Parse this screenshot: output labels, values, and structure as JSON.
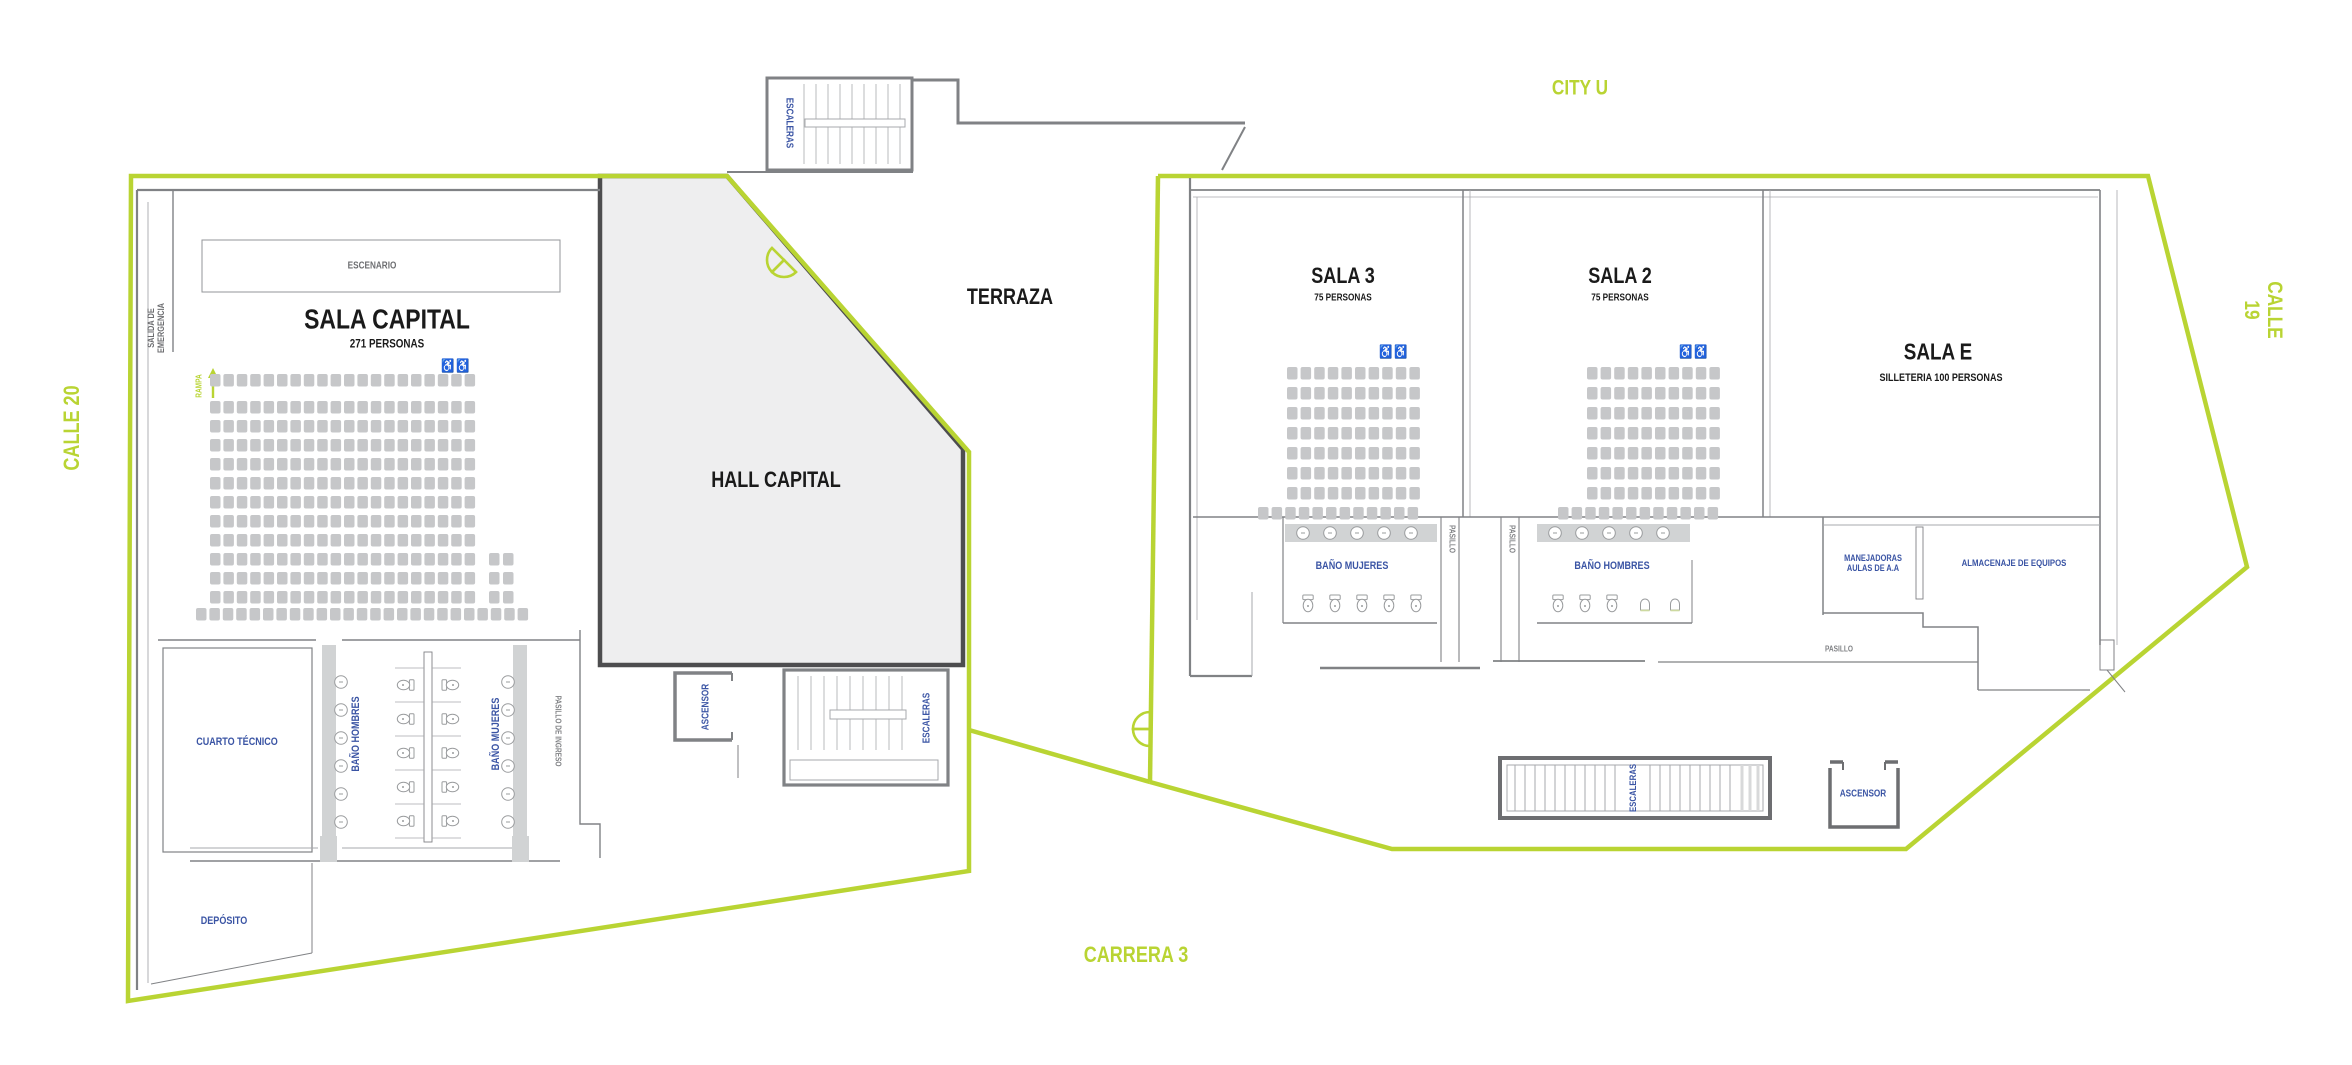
{
  "streets": {
    "left": "CALLE 20",
    "top": "CITY U",
    "right": "CALLE 19",
    "bottom": "CARRERA 3"
  },
  "left_building": {
    "stage": "ESCENARIO",
    "emergency_exit": "SALIDA DE\nEMERGENCIA",
    "ramp": "RAMPA",
    "sala_capital": {
      "title": "SALA CAPITAL",
      "capacity": "271 PERSONAS"
    },
    "hall": "HALL CAPITAL",
    "terrace": "TERRAZA",
    "stairs_top": "ESCALERAS",
    "stairs": "ESCALERAS",
    "elevator": "ASCENSOR",
    "technical_room": "CUARTO TÉCNICO",
    "men_bathroom": "BAÑO HOMBRES",
    "women_bathroom": "BAÑO MUJERES",
    "entry_corridor": "PASILLO DE INGRESO",
    "storage": "DEPÓSITO"
  },
  "right_building": {
    "sala_3": {
      "title": "SALA 3",
      "capacity": "75 PERSONAS"
    },
    "sala_2": {
      "title": "SALA 2",
      "capacity": "75 PERSONAS"
    },
    "sala_e": {
      "title": "SALA E",
      "capacity": "SILLETERIA 100 PERSONAS"
    },
    "women_bathroom": "BAÑO MUJERES",
    "men_bathroom": "BAÑO HOMBRES",
    "corridor_a": "PASILLO",
    "corridor_b": "PASILLO",
    "corridor_c": "PASILLO",
    "ahu_room": "MANEJADORAS\nAULAS DE A.A",
    "equipment_storage": "ALMACENAJE DE EQUIPOS",
    "stairs": "ESCALERAS",
    "elevator": "ASCENSOR"
  },
  "icons": {
    "wheelchair_pair": "♿♿"
  },
  "colors": {
    "accent_green": "#b9d433",
    "label_blue": "#3a54a4",
    "wall_gray": "#808285",
    "wall_light": "#a7a9ac",
    "wall_fill": "#d1d3d4",
    "hall_fill": "#eeeeef",
    "seat_gray": "#c6c7c9"
  },
  "seat_blocks": [
    {
      "name": "sala-capital-front",
      "x": 210,
      "y": 374,
      "rows": 1,
      "cols": 20,
      "pitch_x": 13.4,
      "pitch_y": 19,
      "seat_w": 10.5,
      "seat_h": 12.5
    },
    {
      "name": "sala-capital-main",
      "x": 210,
      "y": 401,
      "rows": 11,
      "cols": 20,
      "pitch_x": 13.4,
      "pitch_y": 19,
      "seat_w": 10.5,
      "seat_h": 12.5
    },
    {
      "name": "sala-capital-side",
      "x": 489,
      "y": 553,
      "rows": 3,
      "cols": 2,
      "pitch_x": 14,
      "pitch_y": 19,
      "seat_w": 10.5,
      "seat_h": 12.5
    },
    {
      "name": "sala-capital-back",
      "x": 196,
      "y": 608,
      "rows": 1,
      "cols": 25,
      "pitch_x": 13.4,
      "pitch_y": 19,
      "seat_w": 10.5,
      "seat_h": 12.5
    },
    {
      "name": "sala3-main",
      "x": 1287,
      "y": 367,
      "rows": 7,
      "cols": 10,
      "pitch_x": 13.6,
      "pitch_y": 20,
      "seat_w": 10.5,
      "seat_h": 12.5
    },
    {
      "name": "sala3-back",
      "x": 1258,
      "y": 507,
      "rows": 1,
      "cols": 12,
      "pitch_x": 13.6,
      "pitch_y": 20,
      "seat_w": 10.5,
      "seat_h": 12.5
    },
    {
      "name": "sala2-main",
      "x": 1587,
      "y": 367,
      "rows": 7,
      "cols": 10,
      "pitch_x": 13.6,
      "pitch_y": 20,
      "seat_w": 10.5,
      "seat_h": 12.5
    },
    {
      "name": "sala2-back",
      "x": 1558,
      "y": 507,
      "rows": 1,
      "cols": 12,
      "pitch_x": 13.6,
      "pitch_y": 20,
      "seat_w": 10.5,
      "seat_h": 12.5
    }
  ]
}
